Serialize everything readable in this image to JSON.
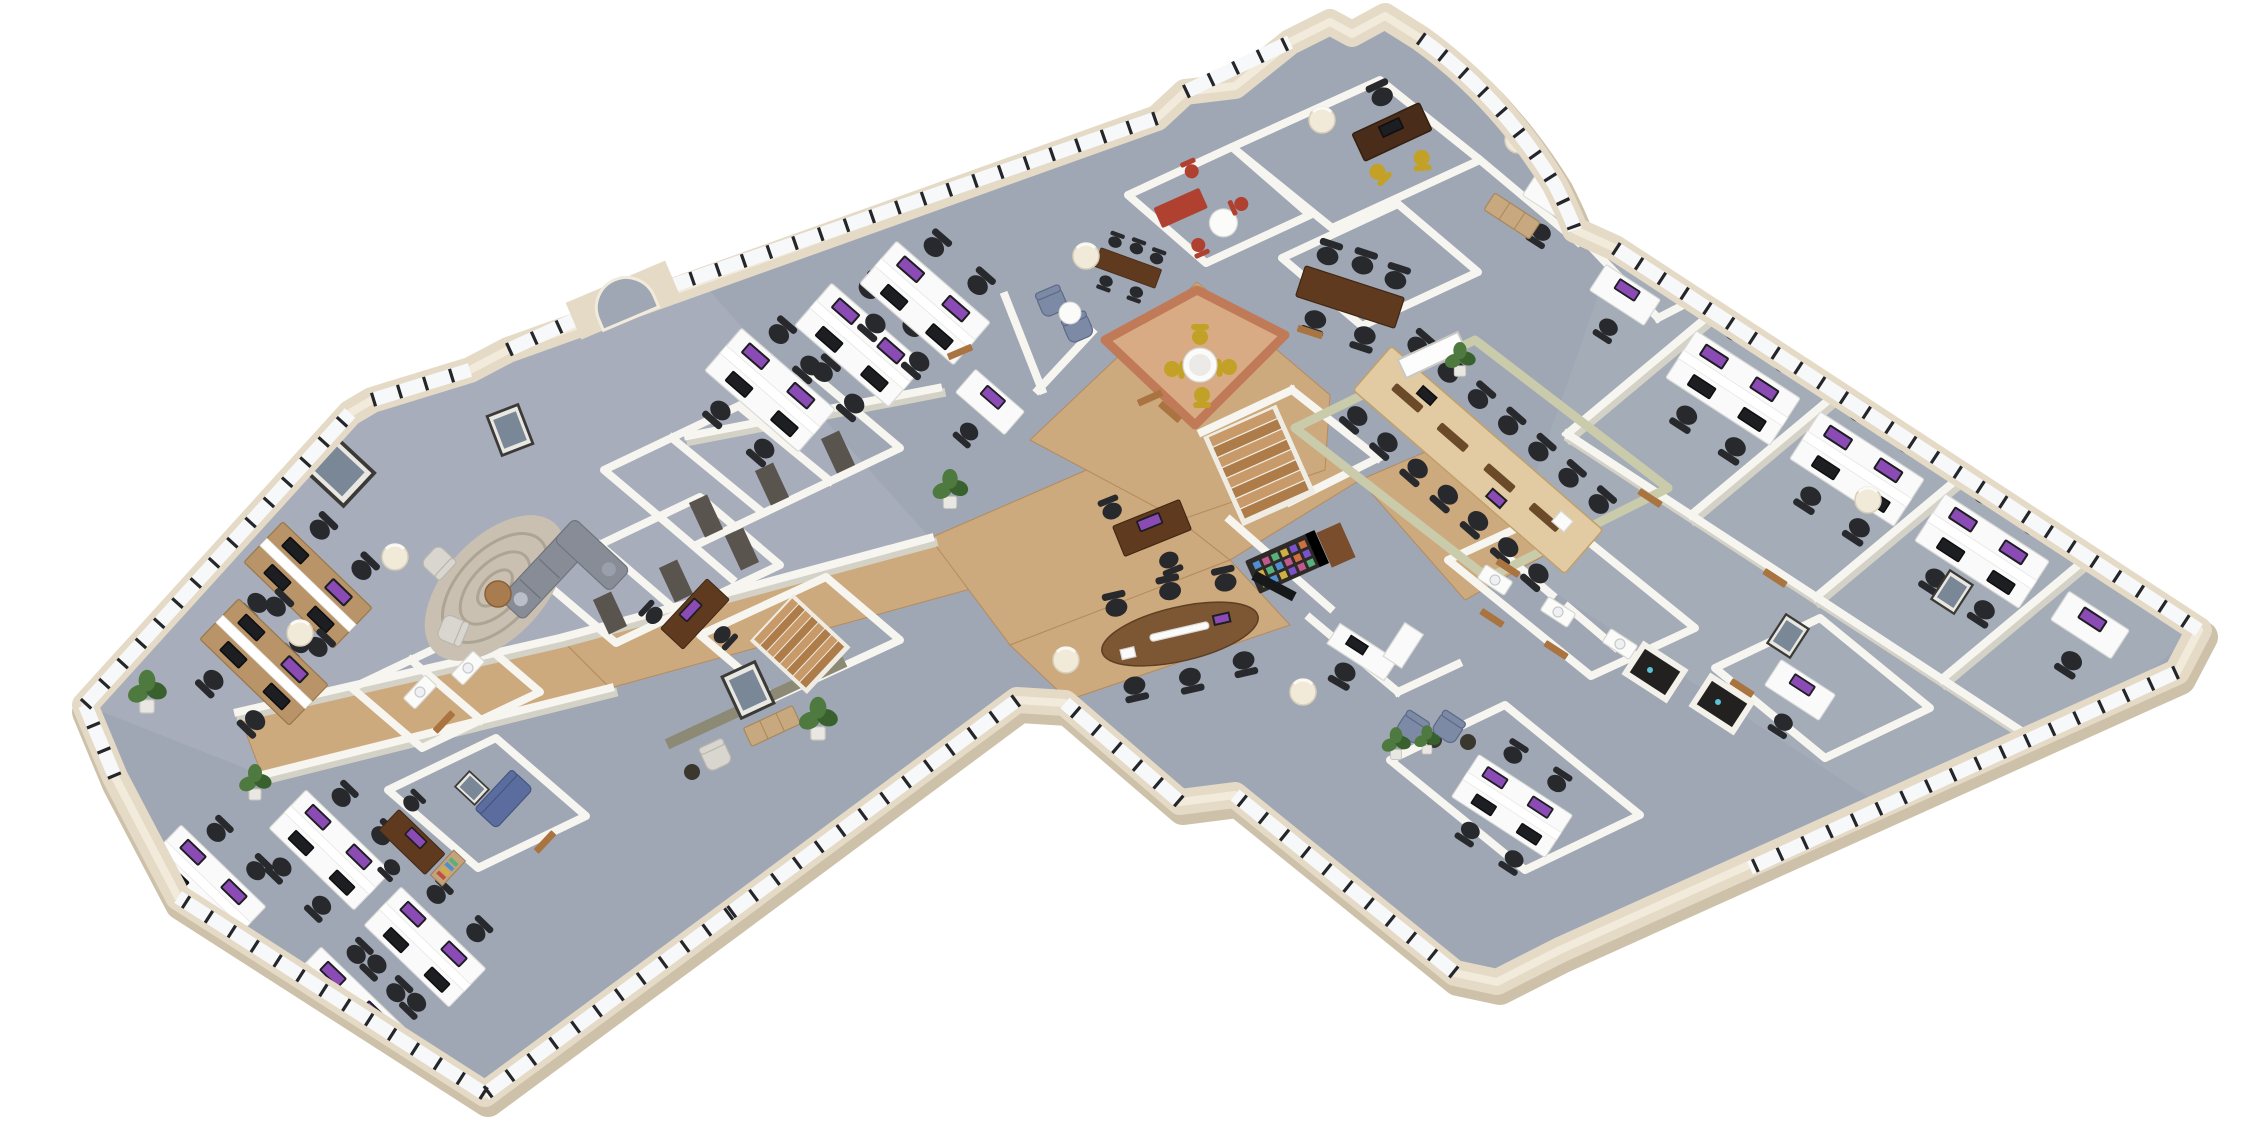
{
  "meta": {
    "kind": "3d-isometric-office-floorplan-render",
    "background": "#ffffff",
    "no_visible_text": true
  },
  "palette": {
    "bg": "#ffffff",
    "carpet": "#9fa7b4",
    "carpet_light": "#adb3bf",
    "wood": "#cda97e",
    "wood_dark": "#b58b5c",
    "wall_ext": "#e4dac6",
    "wall_ext_shadow": "#cdc1a9",
    "wall_ext_hi": "#f2ebdc",
    "wall_int": "#f7f5ef",
    "wall_int_shadow": "#d4d1c6",
    "glass": "#f6f8fa",
    "mullion": "#24262a",
    "sage": "#c9cbaa",
    "olive": "#8c8a74",
    "terracotta": "#c07a57",
    "terracotta_floor": "#d8ab84",
    "desk_white": "#fafafa",
    "desk_wood": "#b99469",
    "desk_dark": "#5f3a1f",
    "table_light": "#e2cba2",
    "table_oval": "#7d5633",
    "exec_desk": "#4a2c1a",
    "chair_black": "#28292d",
    "chair_yellow": "#c3a127",
    "chair_red": "#b0402f",
    "sofa_gray": "#878c96",
    "sofa_blue": "#5a6d9e",
    "lounge_chair": "#7d8aa6",
    "armchair_light": "#d8d6cf",
    "rug": "#c9c0b2",
    "rug_swirl": "#a89c8b",
    "plant": "#4e7a3f",
    "plant_dark": "#39612e",
    "column": "#f1ead9",
    "door_wood": "#a9743f",
    "door_dark": "#5a544e",
    "screen_purple": "#8b4bb5",
    "frame_dark": "#3c3a36",
    "locker_dark": "#2e2a28",
    "stair_a": "#c89a69",
    "stair_b": "#ad7c49"
  },
  "scene": {
    "building": {
      "shape": "angled multi-wing floor plate, pointed west tip, curved north-east lobe, long south-east wing",
      "exterior_walls": "cream",
      "windows": "continuous bands, white glass with black mullions"
    },
    "rooms": [
      {
        "name": "open-plan-office-west",
        "floor": "carpet",
        "desks": 6,
        "monitors": "purple screens"
      },
      {
        "name": "lounge-west",
        "items": [
          "gray L sectional sofa",
          "swirl rug",
          "round wood coffee table",
          "2 light armchairs"
        ]
      },
      {
        "name": "storage-closet-blocks-west",
        "dark_doors": 6
      },
      {
        "name": "stairwell-west",
        "stairs": "oak"
      },
      {
        "name": "reception-lounge-center",
        "feature_wall": "olive with framed art",
        "items": [
          "sideboard",
          "armchair",
          "side table"
        ]
      },
      {
        "name": "washrooms-west",
        "basins": 2
      },
      {
        "name": "office-blue-sofa",
        "items": [
          "blue sofa",
          "framed art",
          "bookshelf",
          "desk"
        ]
      },
      {
        "name": "office-red-accents",
        "items": [
          "red desk",
          "3 red chairs",
          "round white table"
        ]
      },
      {
        "name": "executive-office-north",
        "items": [
          "dark wood desk",
          "2 mustard chairs",
          "column"
        ]
      },
      {
        "name": "private-office-north",
        "items": [
          "white desk",
          "sideboard",
          "black chair"
        ]
      },
      {
        "name": "meeting-room-north",
        "items": [
          "dark wood table",
          "5 black mesh chairs"
        ]
      },
      {
        "name": "breakout-room-terracotta",
        "walls": "terracotta",
        "items": [
          "round marble table",
          "4 yellow chairs"
        ]
      },
      {
        "name": "boardroom-sage",
        "walls": "sage green",
        "seats": 14,
        "items": [
          "long light-oak table",
          "whiteboard",
          "plant"
        ]
      },
      {
        "name": "stair-hall-center",
        "stairs": "oak L-run"
      },
      {
        "name": "locker-nook",
        "items": [
          "dark unit with colorful cubbies",
          "wood cabinet",
          "tv panel"
        ]
      },
      {
        "name": "meeting-area-oval",
        "items": [
          "oval walnut table",
          "6 black chairs"
        ]
      },
      {
        "name": "reception-desk-area",
        "items": [
          "white L desk",
          "partition",
          "chair"
        ]
      },
      {
        "name": "washrooms-center",
        "basins": 3,
        "doors": "wood"
      },
      {
        "name": "utility-rooms-dark",
        "count": 2
      },
      {
        "name": "offices-northeast-wing",
        "count": 4,
        "desks": "white double islands"
      },
      {
        "name": "offices-southeast-wing",
        "count": 3,
        "items": [
          "framed art",
          "blue armchair",
          "plant"
        ]
      },
      {
        "name": "open-desks-south-tip",
        "desks": 4,
        "monitors": "purple screens"
      },
      {
        "name": "lounge-north",
        "items": [
          "2 blue-gray armchairs",
          "round white table",
          "small dark meeting table"
        ]
      },
      {
        "name": "lobe-offices-northeast",
        "desks": 2
      }
    ],
    "totals": {
      "workstation_islands": 22,
      "task_chairs_black": 70,
      "boardroom_seats": 14,
      "staircases": 2,
      "columns": 10,
      "plants": 7,
      "wood_doors": 12,
      "dark_doors": 6,
      "framed_pictures": 7,
      "lounges": 3
    }
  }
}
